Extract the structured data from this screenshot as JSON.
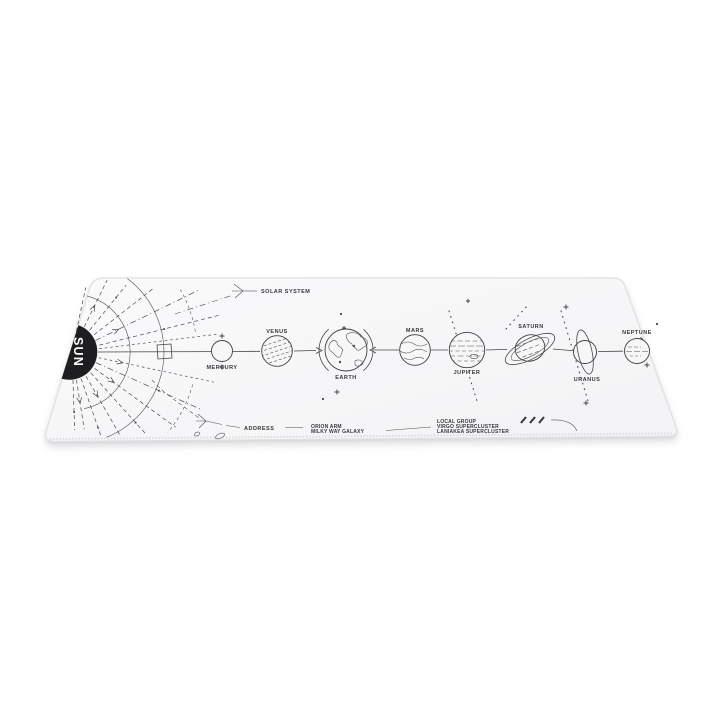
{
  "scene": {
    "background_color": "#ffffff"
  },
  "mat": {
    "surface_color": "#f7f7f8",
    "edge_color": "#e1e1e5",
    "ink_color": "#45454a",
    "sun": {
      "label": "SUN",
      "fill": "#1e1e20",
      "text_color": "#ffffff"
    },
    "system_callout": {
      "label": "SOLAR SYSTEM"
    },
    "planets": [
      {
        "id": "mercury",
        "label": "MERCURY"
      },
      {
        "id": "venus",
        "label": "VENUS"
      },
      {
        "id": "earth",
        "label": "EARTH"
      },
      {
        "id": "mars",
        "label": "MARS"
      },
      {
        "id": "jupiter",
        "label": "JUPITER"
      },
      {
        "id": "saturn",
        "label": "SATURN"
      },
      {
        "id": "uranus",
        "label": "URANUS"
      },
      {
        "id": "neptune",
        "label": "NEPTUNE"
      }
    ],
    "address_callout": {
      "title": "ADDRESS",
      "arm_lines": [
        "ORION ARM",
        "MILKY WAY GALAXY"
      ],
      "group_lines": [
        "LOCAL GROUP",
        "VIRGO SUPERCLUSTER",
        "LANIAKEA SUPERCLUSTER"
      ]
    }
  }
}
